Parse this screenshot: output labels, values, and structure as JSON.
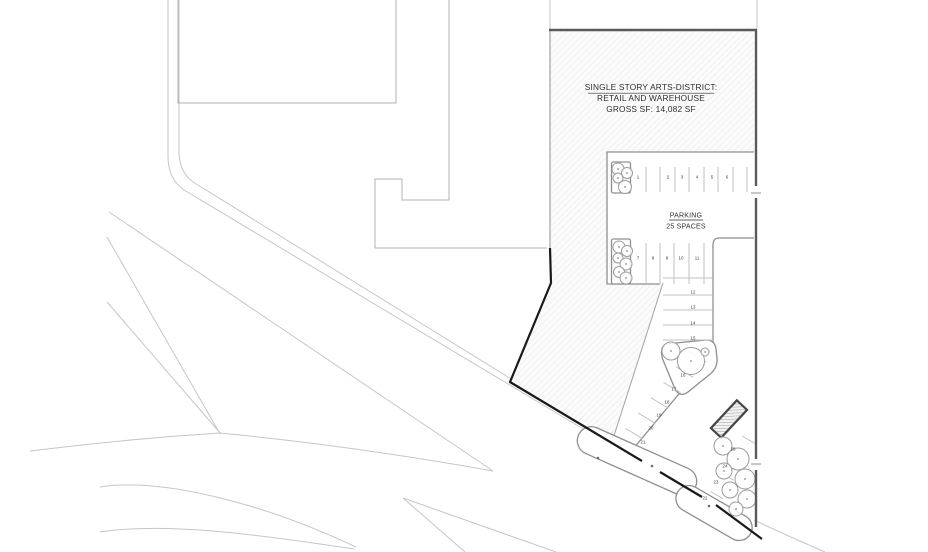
{
  "drawing": {
    "building_label": {
      "line1": "SINGLE STORY ARTS-DISTRICT:",
      "line2": "RETAIL AND WAREHOUSE",
      "line3": "GROSS SF: 14,082 SF"
    },
    "parking_label": {
      "title": "PARKING",
      "subtitle": "25 SPACES"
    },
    "parking_spaces": [
      "1",
      "2",
      "3",
      "4",
      "5",
      "6",
      "7",
      "8",
      "9",
      "10",
      "11",
      "12",
      "13",
      "14",
      "15",
      "16",
      "17",
      "18",
      "19",
      "20",
      "21",
      "22",
      "23",
      "24",
      "25"
    ],
    "colors": {
      "background": "#ffffff",
      "parcel_fill": "#fbfbfb",
      "parcel_hatch_line": "#e2e2e2",
      "road_line": "#c6c6c6",
      "outline_mid": "#8f8f8f",
      "outline_light": "#a9a9a9",
      "adjacent_building_line": "#b3b3b3",
      "boundary_dark": "#5a5a5a",
      "boundary_black": "#1a1a1a",
      "stall_line": "#c2c2c2",
      "tree_outline": "#9b9b9b",
      "text": "#2e2e2e",
      "number": "#3c3c3c"
    }
  }
}
